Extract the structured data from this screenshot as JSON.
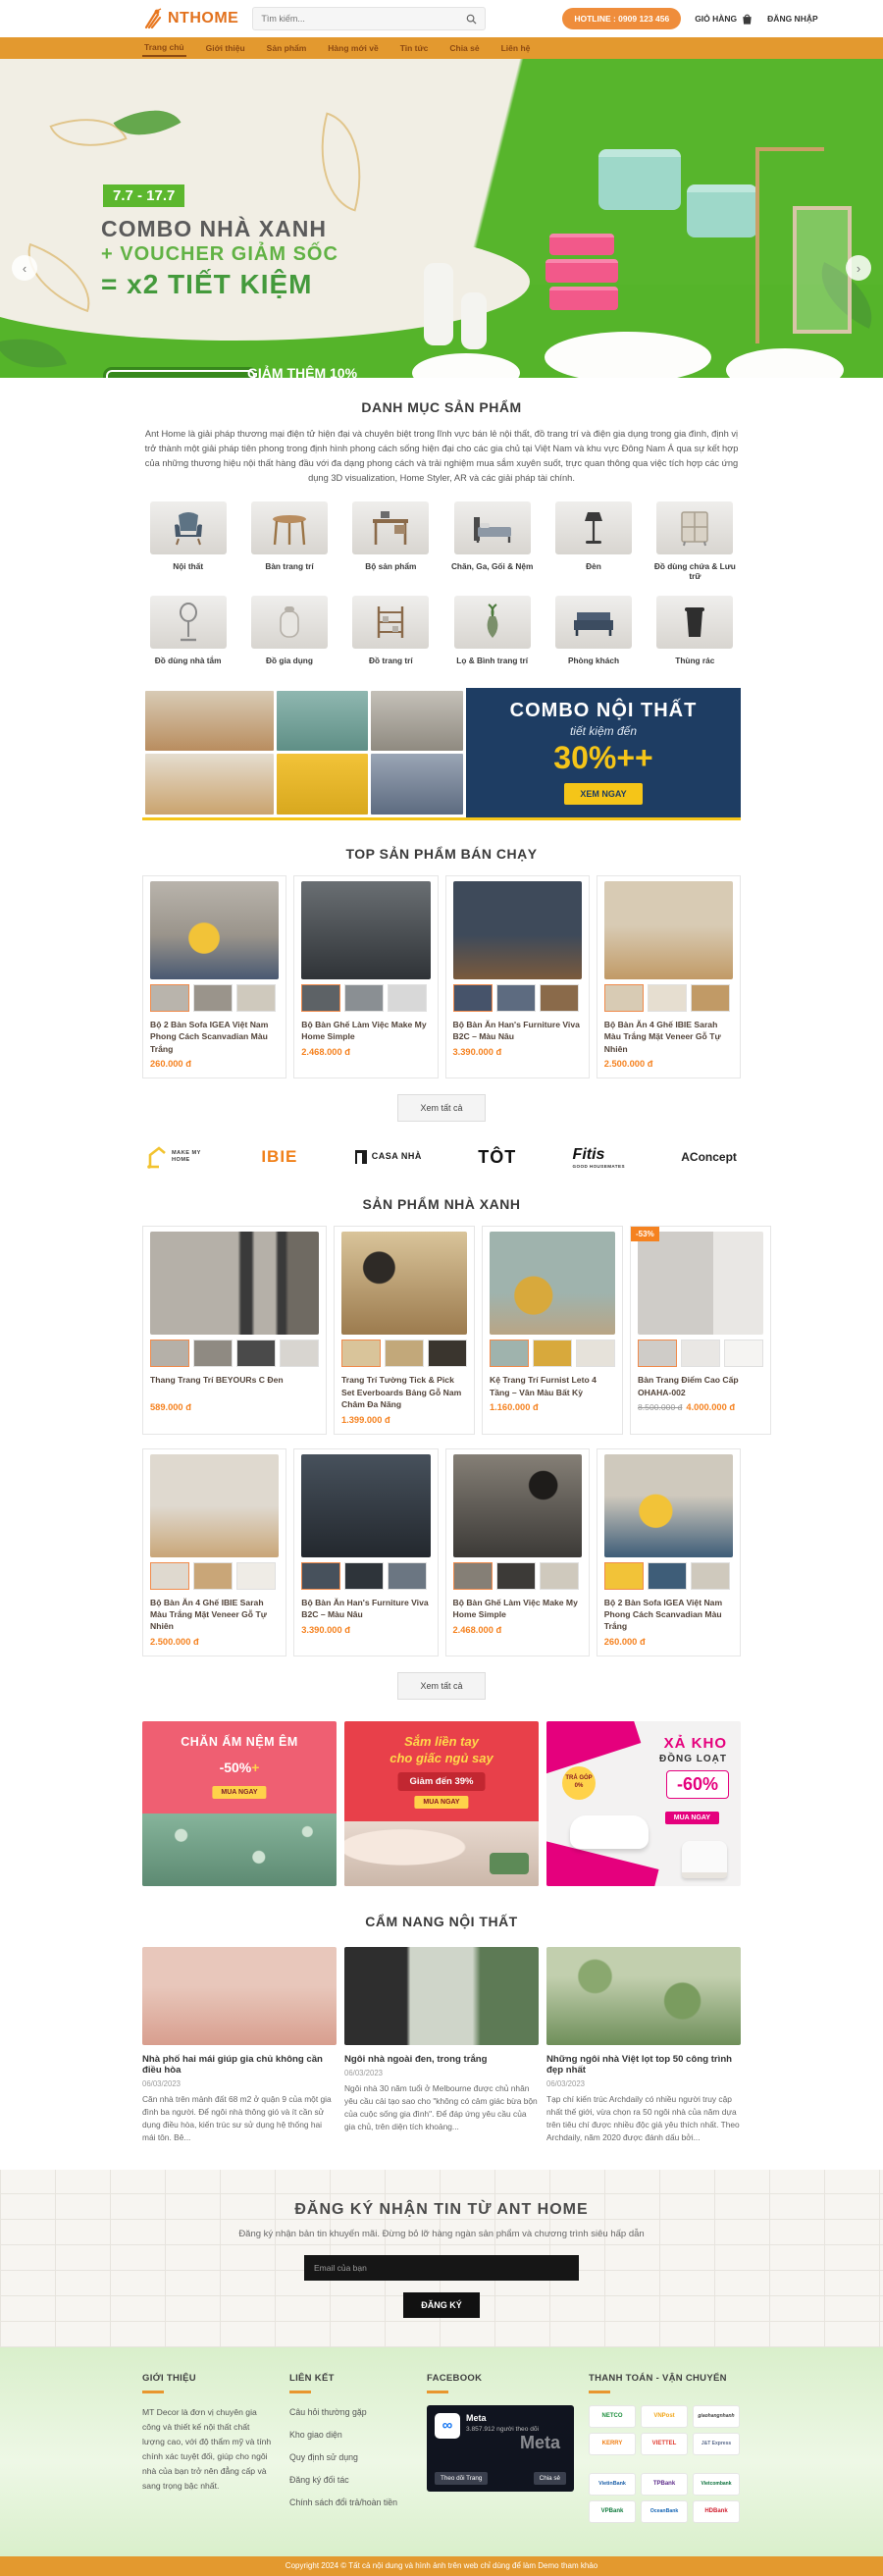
{
  "colors": {
    "accent_orange": "#e3992f",
    "price_orange": "#f58220",
    "hero_green": "#55b42a",
    "combo_navy": "#1e3d63",
    "promo_magenta": "#e5007d"
  },
  "header": {
    "logo_text": "NTHOME",
    "search_placeholder": "Tìm kiếm...",
    "hotline": "HOTLINE : 0909 123 456",
    "cart_label": "GIỎ HÀNG",
    "login_label": "ĐĂNG NHẬP"
  },
  "nav": {
    "items": [
      {
        "label": "Trang chủ"
      },
      {
        "label": "Giới thiệu"
      },
      {
        "label": "Sản phẩm"
      },
      {
        "label": "Hàng mới về"
      },
      {
        "label": "Tin tức"
      },
      {
        "label": "Chia sẻ"
      },
      {
        "label": "Liên hệ"
      }
    ]
  },
  "hero": {
    "date_badge": "7.7 - 17.7",
    "title_line1": "COMBO NHÀ XANH",
    "title_line2": "+ VOUCHER GIẢM SỐC",
    "title_line3": "= x2 TIẾT KIỆM",
    "code_box": "NHẬP MÃ: SPACET10",
    "promo_title": "GIẢM THÊM 10%",
    "promo_sub": "Áp dụng cho các sản phẩm combo có trong chương trình"
  },
  "categories": {
    "heading": "DANH MỤC SẢN PHẨM",
    "description": "Ant Home là giải pháp thương mại điện tử hiện đại và chuyên biệt trong lĩnh vực bán lẻ nội thất, đồ trang trí và điện gia dụng trong gia đình, định vị trở thành một giải pháp tiên phong trong định hình phong cách sống hiện đại cho các gia chủ tại Việt Nam và khu vực Đông Nam Á qua sự kết hợp của những thương hiệu nội thất hàng đầu với đa dạng phong cách và trải nghiệm mua sắm xuyên suốt, trực quan thông qua việc tích hợp các ứng dụng 3D visualization, Home Styler, AR và các giải pháp tài chính.",
    "row1": [
      {
        "label": "Nội thất"
      },
      {
        "label": "Bàn trang trí"
      },
      {
        "label": "Bộ sản phẩm"
      },
      {
        "label": "Chăn, Ga, Gối & Nệm"
      },
      {
        "label": "Đèn"
      },
      {
        "label": "Đồ dùng chứa & Lưu trữ"
      }
    ],
    "row2": [
      {
        "label": "Đồ dùng nhà tắm"
      },
      {
        "label": "Đồ gia dụng"
      },
      {
        "label": "Đồ trang trí"
      },
      {
        "label": "Lọ & Bình trang trí"
      },
      {
        "label": "Phòng khách"
      },
      {
        "label": "Thùng rác"
      }
    ]
  },
  "combo_banner": {
    "title": "COMBO NỘI THẤT",
    "subtitle": "tiết kiệm đến",
    "discount": "30%++",
    "cta": "XEM NGAY"
  },
  "top_products": {
    "heading": "TOP SẢN PHẨM BÁN CHẠY",
    "view_all": "Xem tất cả",
    "items": [
      {
        "name": "Bộ 2 Bàn Sofa IGEA Việt Nam Phong Cách Scanvadian Màu Trắng",
        "price": "260.000 đ"
      },
      {
        "name": "Bộ Bàn Ghế Làm Việc Make My Home Simple",
        "price": "2.468.000 đ"
      },
      {
        "name": "Bộ Bàn Ăn Han's Furniture Viva B2C – Màu Nâu",
        "price": "3.390.000 đ"
      },
      {
        "name": "Bộ Bàn Ăn 4 Ghế IBIE Sarah Màu Trắng Mặt Veneer Gỗ Tự Nhiên",
        "price": "2.500.000 đ"
      }
    ]
  },
  "brands": [
    {
      "name": "MAKE MY HOME"
    },
    {
      "name": "IBIE"
    },
    {
      "name": "CASA NHÀ"
    },
    {
      "name": "TÔT"
    },
    {
      "name": "Fitis",
      "sub": "GOOD HOUSEMATES"
    },
    {
      "name": "AConcept"
    }
  ],
  "green_products": {
    "heading": "SẢN PHẨM NHÀ XANH",
    "view_all": "Xem tất cả",
    "items": [
      {
        "name": "Thang Trang Trí BEYOURs C Đen",
        "price": "589.000 đ"
      },
      {
        "name": "Trang Trí Tường Tick & Pick Set Everboards Bảng Gỗ Nam Châm Đa Năng",
        "price": "1.399.000 đ"
      },
      {
        "name": "Kệ Trang Trí Furnist Leto 4 Tầng – Vân Màu Bất Kỳ",
        "price": "1.160.000 đ"
      },
      {
        "name": "Bàn Trang Điểm Cao Cấp OHAHA-002",
        "old_price": "8.500.000 đ",
        "price": "4.000.000 đ",
        "badge": "-53%"
      },
      {
        "name": "Bộ Bàn Ăn 4 Ghế IBIE Sarah Màu Trắng Mặt Veneer Gỗ Tự Nhiên",
        "price": "2.500.000 đ"
      },
      {
        "name": "Bộ Bàn Ăn Han's Furniture Viva B2C – Màu Nâu",
        "price": "3.390.000 đ"
      },
      {
        "name": "Bộ Bàn Ghế Làm Việc Make My Home Simple",
        "price": "2.468.000 đ"
      },
      {
        "name": "Bộ 2 Bàn Sofa IGEA Việt Nam Phong Cách Scanvadian Màu Trắng",
        "price": "260.000 đ"
      }
    ]
  },
  "promo_banners": [
    {
      "title": "CHĂN ẤM NỆM ÊM",
      "discount": "-50%",
      "discount_suffix": "+",
      "cta": "MUA NGAY"
    },
    {
      "title_line1": "Sắm liền tay",
      "title_line2": "cho giấc ngủ say",
      "discount": "Giảm đến 39%",
      "cta": "MUA NGAY"
    },
    {
      "badge": "TRẢ GÓP 0%",
      "title_line1": "XẢ KHO",
      "title_line2": "ĐỒNG LOẠT",
      "discount": "-60%",
      "cta": "MUA NGAY"
    }
  ],
  "blog": {
    "heading": "CẨM NANG NỘI THẤT",
    "posts": [
      {
        "title": "Nhà phố hai mái giúp gia chủ không cần điều hòa",
        "date": "06/03/2023",
        "excerpt": "Căn nhà trên mảnh đất 68 m2 ở quận 9 của một gia đình ba người. Để ngôi nhà thông gió và ít cần sử dụng điều hòa, kiến trúc sư sử dụng hệ thống hai mái tôn. Bê..."
      },
      {
        "title": "Ngôi nhà ngoài đen, trong trắng",
        "date": "06/03/2023",
        "excerpt": "Ngôi nhà 30 năm tuổi ở Melbourne được chủ nhân yêu cầu cải tạo sao cho \"không có cảm giác bừa bộn của cuộc sống gia đình\". Để đáp ứng yêu cầu của gia chủ, trên diện tích khoảng..."
      },
      {
        "title": "Những ngôi nhà Việt lọt top 50 công trình đẹp nhất",
        "date": "06/03/2023",
        "excerpt": "Tạp chí kiến trúc Archdaily có nhiều người truy cập nhất thế giới, vừa chọn ra 50 ngôi nhà của năm dựa trên tiêu chí được nhiều độc giả yêu thích nhất. Theo Archdaily, năm 2020 được đánh dấu bởi..."
      }
    ]
  },
  "newsletter": {
    "title": "ĐĂNG KÝ NHẬN TIN TỪ ANT HOME",
    "subtitle": "Đăng ký nhận bản tin khuyến mãi. Đừng bỏ lỡ hàng ngàn sản phẩm và chương trình siêu hấp dẫn",
    "placeholder": "Email của bạn",
    "button": "ĐĂNG KÝ"
  },
  "footer": {
    "about": {
      "heading": "GIỚI THIỆU",
      "text": "MT Decor là đơn vị chuyên gia công và thiết kế nội thất chất lượng cao, với độ thẩm mỹ và tính chính xác tuyệt đối, giúp cho ngôi nhà của bạn trở nên đẳng cấp và sang trọng bậc nhất."
    },
    "links": {
      "heading": "LIÊN KẾT",
      "items": [
        {
          "label": "Câu hỏi thường gặp"
        },
        {
          "label": "Kho giao diện"
        },
        {
          "label": "Quy định sử dụng"
        },
        {
          "label": "Đăng ký đối tác"
        },
        {
          "label": "Chính sách đổi trả/hoàn tiền"
        }
      ]
    },
    "facebook": {
      "heading": "FACEBOOK",
      "page_name": "Meta",
      "followers": "3.857.912 người theo dõi",
      "watermark": "Meta",
      "follow_button": "Theo dõi Trang",
      "share_button": "Chia sẻ"
    },
    "payment": {
      "heading": "THANH TOÁN - VẬN CHUYỂN",
      "logos": [
        {
          "name": "NETCO"
        },
        {
          "name": "VNPost"
        },
        {
          "name": "giaohangnhanh"
        },
        {
          "name": "KERRY"
        },
        {
          "name": "VIETTEL"
        },
        {
          "name": "J&T Express"
        },
        {
          "name": "VietinBank"
        },
        {
          "name": "TPBank"
        },
        {
          "name": "Vietcombank"
        },
        {
          "name": "VPBank"
        },
        {
          "name": "OceanBank"
        },
        {
          "name": "HDBank"
        }
      ]
    }
  },
  "copyright": "Copyright 2024 © Tất cả nội dung và hình ảnh trên web chỉ dùng để làm Demo tham khảo"
}
